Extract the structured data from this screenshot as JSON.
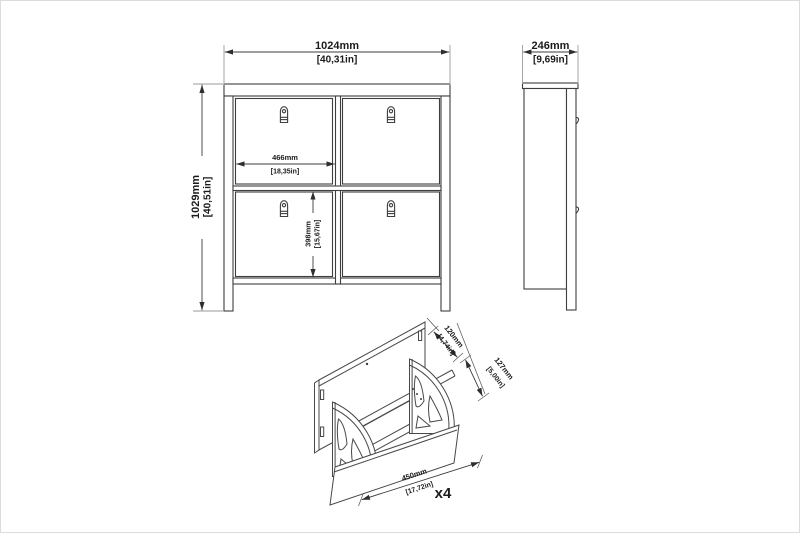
{
  "colors": {
    "line": "#3e3e3e",
    "dimension_line": "#3c3c3c",
    "extension_line": "#9a9a9a",
    "text": "#1b1b1b",
    "background": "#ffffff"
  },
  "front_view": {
    "width_mm": "1024mm",
    "width_in": "[40,31in]",
    "height_mm": "1029mm",
    "height_in": "[40,51in]",
    "compartment_width_mm": "466mm",
    "compartment_width_in": "[18,35in]",
    "compartment_height_mm": "398mm",
    "compartment_height_in": "[15,67in]"
  },
  "side_view": {
    "depth_mm": "246mm",
    "depth_in": "[9,69in]"
  },
  "detail_view": {
    "flap_top_mm": "120mm",
    "flap_top_in": "[4,74in]",
    "flap_front_mm": "127mm",
    "flap_front_in": "[5,00in]",
    "inner_width_mm": "450mm",
    "inner_width_in": "[17,72in]",
    "quantity": "x4"
  }
}
